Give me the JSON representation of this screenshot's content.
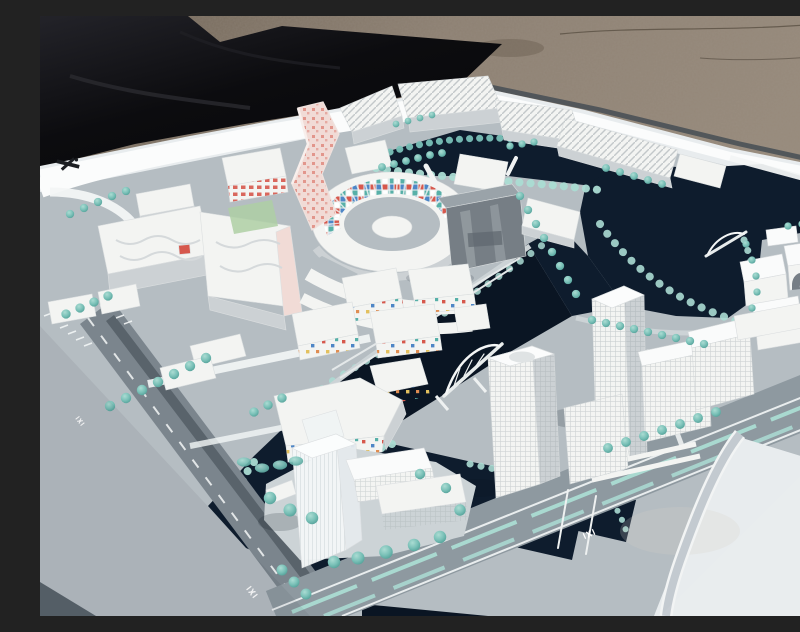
{
  "scene": {
    "type": "photograph",
    "description": "Photograph of a white architectural scale model of a waterfront city district, displayed outdoors on a large white board laid beside a black tarp on gravel ground. Dark navy canals wind between white model buildings, turquoise model trees line gray streets, and a wide boulevard with teal medians crosses the lower right.",
    "environment": {
      "ground": "gravel and dirt",
      "covering": "black tarp at upper left",
      "base": "white presentation board with gray model surface"
    },
    "palette": {
      "ground": "#8d8072",
      "ground_dark": "#6e6254",
      "tarp": "#0c0c0f",
      "tarp_light": "#232329",
      "board": "#e8ecee",
      "board_rim": "#fbfcfc",
      "board_edge": "#4a5157",
      "surface": "#b5bdc2",
      "surface_light": "#ccd3d6",
      "boulevard": "#8e99a0",
      "water": "#0e1c2d",
      "water_deep": "#0a1523",
      "shore": "#9fd6cc",
      "road": "#7b858d",
      "road_dark": "#59636b",
      "lane": "#f3f6f6",
      "white_bld": "#f3f4f2",
      "bld_shade": "#ccd1d4",
      "bld_dark": "#aeb5ba",
      "glass": "#767e85",
      "glass_light": "#9aa3a9",
      "tree": "#79c0b7",
      "tree_dark": "#4f9d95",
      "tree_light": "#abdcd3",
      "lawn": "#aecfa5",
      "pink_light": "#f1dbd6",
      "pink_dot": "#e2968c",
      "red": "#d6584d",
      "blue": "#4e86c6",
      "yellow": "#e3c05e",
      "teal": "#57b0a8",
      "orange": "#df8d52",
      "shadow": "#0a1420"
    },
    "landmarks": [
      {
        "name": "spiral-tower",
        "desc": "Twisted tapering tower with pink dotted facade"
      },
      {
        "name": "ring-courtyard-building",
        "desc": "Circular courtyard building, inner facade with red/blue/teal mosaic tiles"
      },
      {
        "name": "gray-slab-building",
        "desc": "Dark reflective slab building at center"
      },
      {
        "name": "north-industrial-blocks",
        "desc": "Sawtooth-roof white blocks along north canal"
      },
      {
        "name": "west-complex",
        "desc": "Large white complex with wavy roof lines and pink side wall"
      },
      {
        "name": "confetti-midrises",
        "desc": "White mid-rise blocks with scattered colored facade dots"
      },
      {
        "name": "pentagon-dot-building",
        "desc": "Five-sided block with multicolored facade dots"
      },
      {
        "name": "east-highrise",
        "desc": "Tall white gridded tower on the east peninsula"
      },
      {
        "name": "center-highrise",
        "desc": "Tall faceted white tower by the central canal"
      },
      {
        "name": "south-translucent-tower",
        "desc": "Frosted translucent high-rise on the south peninsula"
      },
      {
        "name": "east-cube-cluster",
        "desc": "Cluster of white cubic volumes with arched bar at east edge"
      },
      {
        "name": "arch-bridges",
        "desc": "White arched bridges crossing the canals"
      }
    ],
    "markings": {
      "board_logo": "small dark emblem on white ramp at left edge of board",
      "road_symbol": "small white transit glyph painted on roads (3 places)"
    }
  }
}
